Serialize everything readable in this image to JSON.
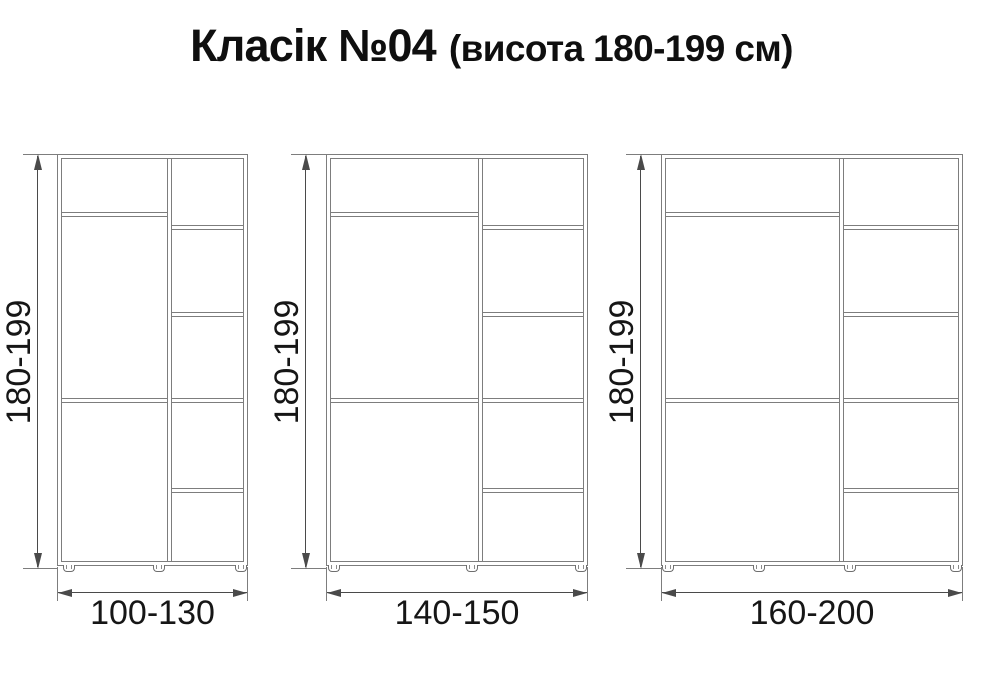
{
  "title": {
    "main": "Класік №04",
    "sub": "(висота 180-199 см)"
  },
  "diagram": {
    "type": "furniture-dimension-drawing",
    "canvas": {
      "width": 983,
      "height": 700,
      "background": "#ffffff"
    },
    "style": {
      "board_line_color": "#7d7d7d",
      "dimension_line_color": "#4a4a4a",
      "label_text_color": "#161616"
    },
    "shared": {
      "top": 154,
      "cabinet_height": 412,
      "board_thickness": 5,
      "left_column_shelves_y": [
        58,
        244
      ],
      "right_column_shelves_y": [
        71,
        158,
        244,
        334
      ],
      "foot": {
        "w": 12,
        "h": 7
      },
      "vdim": {
        "y1": 154,
        "y2": 569,
        "label_cy": 362
      },
      "hdim": {
        "ext_y1": 567,
        "ext_y2": 601,
        "line_y": 592,
        "label_top": 594
      }
    },
    "wardrobes": [
      {
        "id": 1,
        "height_label": "180-199",
        "width_label": "100-130",
        "left": 57,
        "width": 191,
        "divider_x": 110,
        "feet_x": [
          6,
          96,
          178
        ],
        "vdim_x": 37,
        "vlabel_cx": 19,
        "left_column_sections": 3,
        "right_column_sections": 5,
        "feet_count": 3
      },
      {
        "id": 2,
        "height_label": "180-199",
        "width_label": "140-150",
        "left": 326,
        "width": 262,
        "divider_x": 152,
        "feet_x": [
          2,
          140,
          249
        ],
        "vdim_x": 305,
        "vlabel_cx": 287,
        "left_column_sections": 3,
        "right_column_sections": 5,
        "feet_count": 3
      },
      {
        "id": 3,
        "height_label": "180-199",
        "width_label": "160-200",
        "left": 661,
        "width": 302,
        "divider_x": 178,
        "feet_x": [
          1,
          92,
          183,
          289
        ],
        "vdim_x": 640,
        "vlabel_cx": 622,
        "left_column_sections": 3,
        "right_column_sections": 5,
        "feet_count": 4
      }
    ]
  }
}
